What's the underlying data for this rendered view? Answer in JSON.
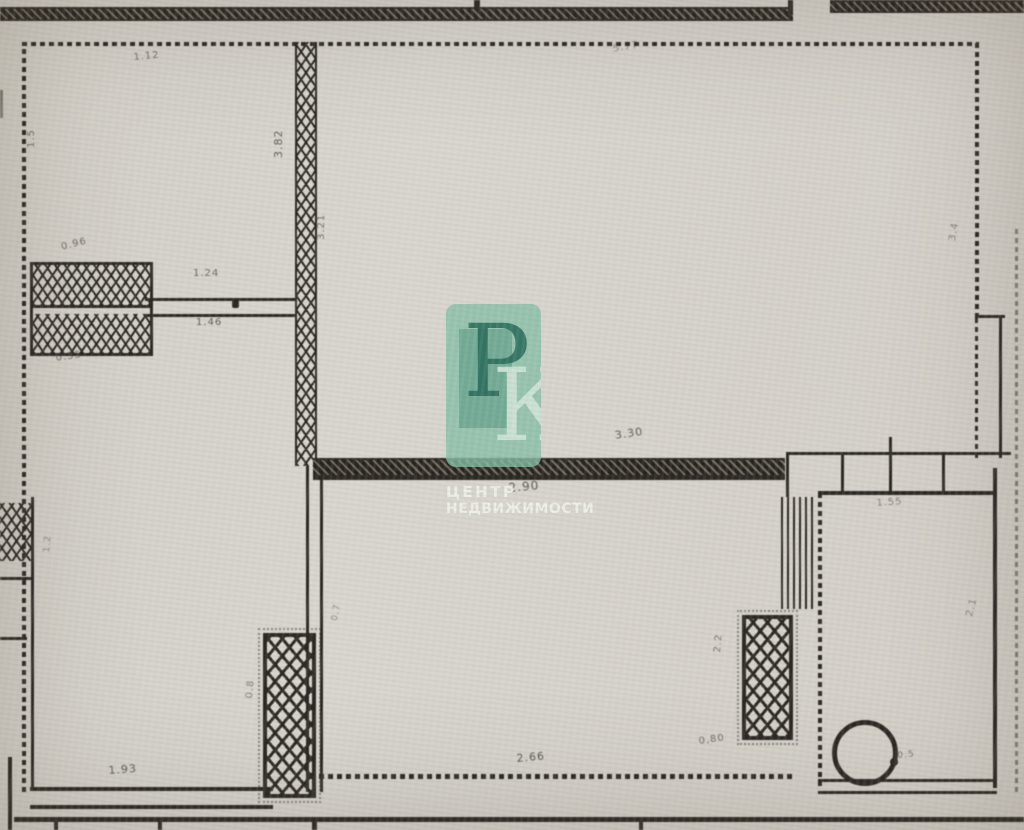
{
  "colors": {
    "paper": "#d6d2cb",
    "ink": "#2b2722",
    "ink-faded": "#45403a",
    "accent": "#84bda3"
  },
  "watermark": {
    "logo_letter_1": "Р",
    "logo_letter_2": "К",
    "caption_line_1": "ЦЕНТР",
    "caption_line_2": "НЕДВИЖИМОСТИ"
  },
  "dimensions": [
    {
      "text": "4.04",
      "x": 386,
      "y": -4,
      "rot": 180,
      "size": 11,
      "opacity": 0.8
    },
    {
      "text": "1.12",
      "x": 133,
      "y": 52,
      "rot": -5,
      "size": 10,
      "opacity": 0.7
    },
    {
      "text": "1.5",
      "x": 26,
      "y": 148,
      "rot": -90,
      "size": 10,
      "opacity": 0.7
    },
    {
      "text": "3.82",
      "x": 272,
      "y": 158,
      "rot": -90,
      "size": 11,
      "opacity": 0.8
    },
    {
      "text": "3.21",
      "x": 316,
      "y": 240,
      "rot": -90,
      "size": 10,
      "opacity": 0.7
    },
    {
      "text": "5.77",
      "x": 612,
      "y": 44,
      "rot": -10,
      "size": 10,
      "opacity": 0.5
    },
    {
      "text": "3.4",
      "x": 947,
      "y": 240,
      "rot": -80,
      "size": 10,
      "opacity": 0.55
    },
    {
      "text": "0.96",
      "x": 60,
      "y": 242,
      "rot": -14,
      "size": 10,
      "opacity": 0.7
    },
    {
      "text": "1.24",
      "x": 193,
      "y": 268,
      "rot": 0,
      "size": 10,
      "opacity": 0.75
    },
    {
      "text": "1.46",
      "x": 196,
      "y": 317,
      "rot": 0,
      "size": 10,
      "opacity": 0.8
    },
    {
      "text": "0.55",
      "x": 55,
      "y": 353,
      "rot": -8,
      "size": 10,
      "opacity": 0.7
    },
    {
      "text": "3.30",
      "x": 614,
      "y": 429,
      "rot": -8,
      "size": 11,
      "opacity": 0.85
    },
    {
      "text": "2.90",
      "x": 508,
      "y": 481,
      "rot": -5,
      "size": 12,
      "opacity": 0.85
    },
    {
      "text": "1.55",
      "x": 876,
      "y": 498,
      "rot": -4,
      "size": 10,
      "opacity": 0.55
    },
    {
      "text": "1.2",
      "x": 42,
      "y": 552,
      "rot": -85,
      "size": 9,
      "opacity": 0.5
    },
    {
      "text": "0.7",
      "x": 330,
      "y": 620,
      "rot": -80,
      "size": 9,
      "opacity": 0.5
    },
    {
      "text": "2.1",
      "x": 964,
      "y": 615,
      "rot": -75,
      "size": 10,
      "opacity": 0.55
    },
    {
      "text": "2.2",
      "x": 712,
      "y": 652,
      "rot": -85,
      "size": 10,
      "opacity": 0.65
    },
    {
      "text": "0.8",
      "x": 244,
      "y": 698,
      "rot": -85,
      "size": 10,
      "opacity": 0.6
    },
    {
      "text": "0,80",
      "x": 698,
      "y": 736,
      "rot": -8,
      "size": 10,
      "opacity": 0.7
    },
    {
      "text": "0.5",
      "x": 897,
      "y": 751,
      "rot": -5,
      "size": 9,
      "opacity": 0.65
    },
    {
      "text": "2.66",
      "x": 516,
      "y": 752,
      "rot": -5,
      "size": 11,
      "opacity": 0.85
    },
    {
      "text": "1.93",
      "x": 108,
      "y": 764,
      "rot": -4,
      "size": 11,
      "opacity": 0.85
    }
  ]
}
